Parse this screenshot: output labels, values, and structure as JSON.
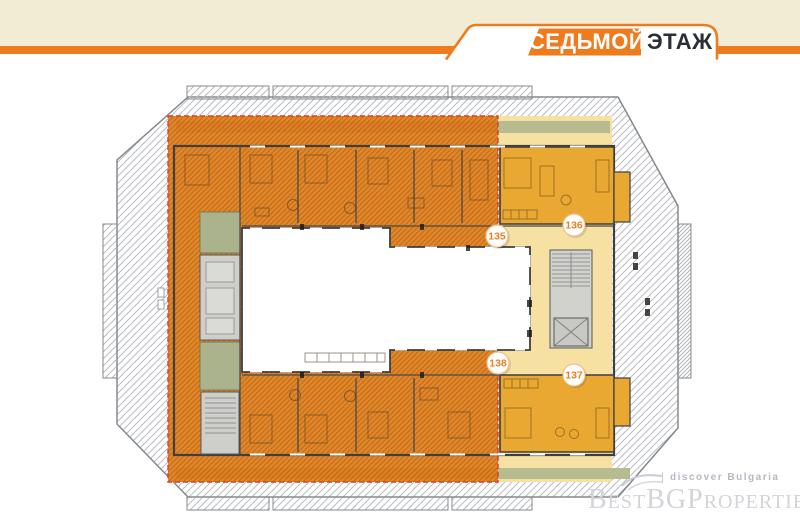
{
  "header": {
    "floor_label": {
      "primary": "СЕДЬМОЙ",
      "secondary": "ЭТАЖ"
    },
    "colors": {
      "strip": "#f2ecd4",
      "accent": "#ee7c1f",
      "text_dark": "#2a2f36"
    }
  },
  "plan": {
    "apartments": [
      {
        "number": "135",
        "zone": "orange-highlight"
      },
      {
        "number": "136",
        "zone": "gold-unit"
      },
      {
        "number": "137",
        "zone": "gold-unit"
      },
      {
        "number": "138",
        "zone": "orange-highlight"
      }
    ],
    "colors": {
      "highlight_overlay": "#e0801f",
      "unit_gold": "#e9a832",
      "corridor_pale": "#f6e1a2",
      "terrace_green": "#8b9065",
      "terrace_green_light": "#b7bb90",
      "core_gray": "#d2d2cd",
      "boundary_red": "#e23a2b"
    }
  },
  "watermark": {
    "tagline": "discover Bulgaria",
    "brand": "BestBGProperties"
  }
}
